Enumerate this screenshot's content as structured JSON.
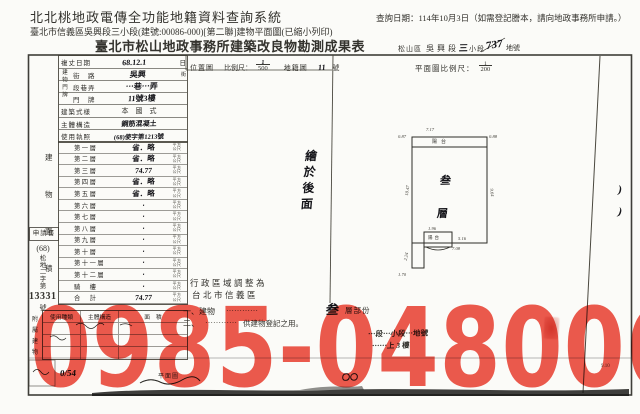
{
  "header": {
    "system_title": "北北桃地政電傳全功能地籍資料查詢系統",
    "query_date": "查詢日期：114年10月3日（如需登記謄本，請向地政事務所申請。）",
    "subtitle": "臺北市信義區吳興段三小段(建號:00086-000)[第二聯]建物平面圖(已縮小列印)"
  },
  "doc": {
    "title": "臺北市松山地政事務所建築改良物勘測成果表",
    "district": "松山區",
    "section": "吳興段",
    "subsection_hw": "三",
    "subsection_label": "小段",
    "parcel_hw": "737",
    "parcel_label": "地號",
    "form": {
      "survey_date_label": "複丈日期",
      "survey_date_value": "68.12.1",
      "survey_date_unit": "日",
      "address_group": "建物門牌",
      "street_label": "街　路",
      "street_value": "吳興",
      "street_unit": "街",
      "lane_label": "段巷弄",
      "lane_value": "⋯巷⋯弄",
      "door_label": "門　牌",
      "door_value": "11號3樓",
      "style_label": "建築式樣",
      "style_value": "本　國　式",
      "structure_label": "主體構造",
      "structure_value": "鋼筋混凝土",
      "license_label": "使用執照",
      "license_value": "(68)使字第1213號"
    },
    "floor_table": {
      "side_label": [
        "建",
        "物",
        "面",
        "積"
      ],
      "unit_top": "平方",
      "unit_bottom": "公尺",
      "rows": [
        {
          "label": "第一層",
          "value": "省．略"
        },
        {
          "label": "第二層",
          "value": "省．略"
        },
        {
          "label": "第三層",
          "value": "74.77"
        },
        {
          "label": "第四層",
          "value": "省．略"
        },
        {
          "label": "第五層",
          "value": "省．略"
        },
        {
          "label": "第六層",
          "value": "‧"
        },
        {
          "label": "第七層",
          "value": "‧"
        },
        {
          "label": "第八層",
          "value": "‧"
        },
        {
          "label": "第九層",
          "value": "‧"
        },
        {
          "label": "第十層",
          "value": "‧"
        },
        {
          "label": "第十一層",
          "value": "‧"
        },
        {
          "label": "第十二層",
          "value": "‧"
        },
        {
          "label": "騎　樓",
          "value": "‧"
        },
        {
          "label": "合　計",
          "value": "74.77"
        }
      ]
    },
    "margin": {
      "box": "申請書",
      "year": "(68)",
      "word": [
        "松",
        "地",
        "二",
        "字",
        "第"
      ],
      "number": "13331",
      "suffix": "號"
    },
    "annex": {
      "side_label": [
        "附",
        "屬",
        "建",
        "物"
      ],
      "headers": [
        "使用種類",
        "主體構造",
        "面　積"
      ]
    },
    "location": {
      "label": "位置圖",
      "scale_label": "比例尺：",
      "num": "1",
      "den": "500",
      "map": "地籍圖",
      "map_no": "11",
      "map_unit": "號"
    },
    "plan": {
      "scale_label": "平面圖比例尺：",
      "num": "1",
      "den": "200",
      "balcony": "陽台",
      "floor_hw": [
        "叁",
        "層"
      ],
      "balcony2": "陽台",
      "dims": {
        "top": "7.17",
        "top_left": "0.87",
        "top_right": "0.88",
        "left": "10.47",
        "right": "9.64",
        "bump_top": "1.96",
        "bump_right": "5.16",
        "bump_bottom": "7.08",
        "bump_left": "2.24",
        "foot": "1.70"
      }
    },
    "drawn_note": [
      "繪",
      "於",
      "後",
      "面"
    ],
    "admin_note": [
      "行政區域調整為",
      "台北市信義區"
    ],
    "notes": {
      "n1_prefix": "一、建物",
      "ellipsis": "⋯⋯⋯⋯",
      "n1_floor": "叁",
      "n1_suffix": "層部份",
      "n2_prefix": "二、",
      "n2_suffix": "供建物登記之用。",
      "hw1": "⋯段⋯小段⋯地號",
      "hw2": "⋯⋯上 3 樓"
    },
    "footer": {
      "frag1": "0/54",
      "frag2": "平面圖",
      "frag3": "〇〇",
      "code": "9.10"
    },
    "margin_marks": [
      ")",
      ")"
    ]
  },
  "watermark": {
    "text": "0985-048006",
    "color": "#ee5a4e"
  }
}
